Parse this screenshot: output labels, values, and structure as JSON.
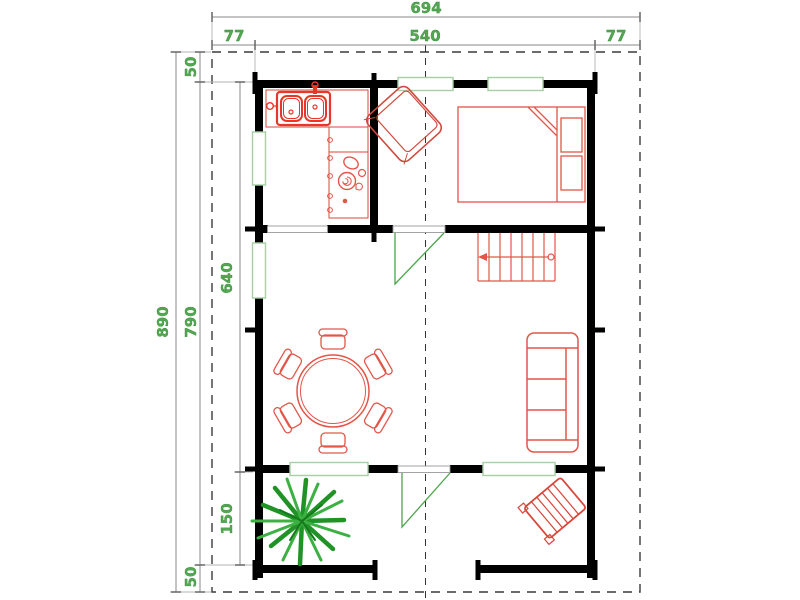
{
  "drawing": {
    "kind": "log-cabin floor plan, plan view with dimension chains",
    "background": "#ffffff"
  },
  "dimensions_cm": {
    "top_total": "694",
    "top_left": "77",
    "top_center": "540",
    "top_right": "77",
    "side_total": "890",
    "side_top": "50",
    "side_main": "790",
    "side_bottom": "50",
    "inner_upper": "640",
    "inner_lower": "150"
  },
  "colors": {
    "walls": "#000000",
    "furniture_red": "#e2564a",
    "sink_red": "#e8372a",
    "window_green": "#a6cfa4",
    "door_green": "#4aa54a",
    "plant_green": "#1f9325",
    "plant_green_light": "#3cb043",
    "dimension_text": "#53a753",
    "dimension_line": "#8a8a8a",
    "roof_dash": "#3a3a3a",
    "section_dash": "#333333"
  },
  "elements": {
    "furniture": [
      "double-sink",
      "kitchen-counter",
      "stove-burner",
      "armchair",
      "double-bed",
      "staircase",
      "dining-table",
      "dining-chair",
      "sofa",
      "garden-bench",
      "plant"
    ],
    "openings": [
      "window-top-1",
      "window-top-2",
      "window-left-1",
      "window-left-2",
      "window-bottom-1",
      "window-bottom-2",
      "door-kitchen",
      "door-bedroom",
      "door-terrace"
    ],
    "outlines": [
      "roof-overhang-dashed",
      "section-line-dashed"
    ]
  }
}
